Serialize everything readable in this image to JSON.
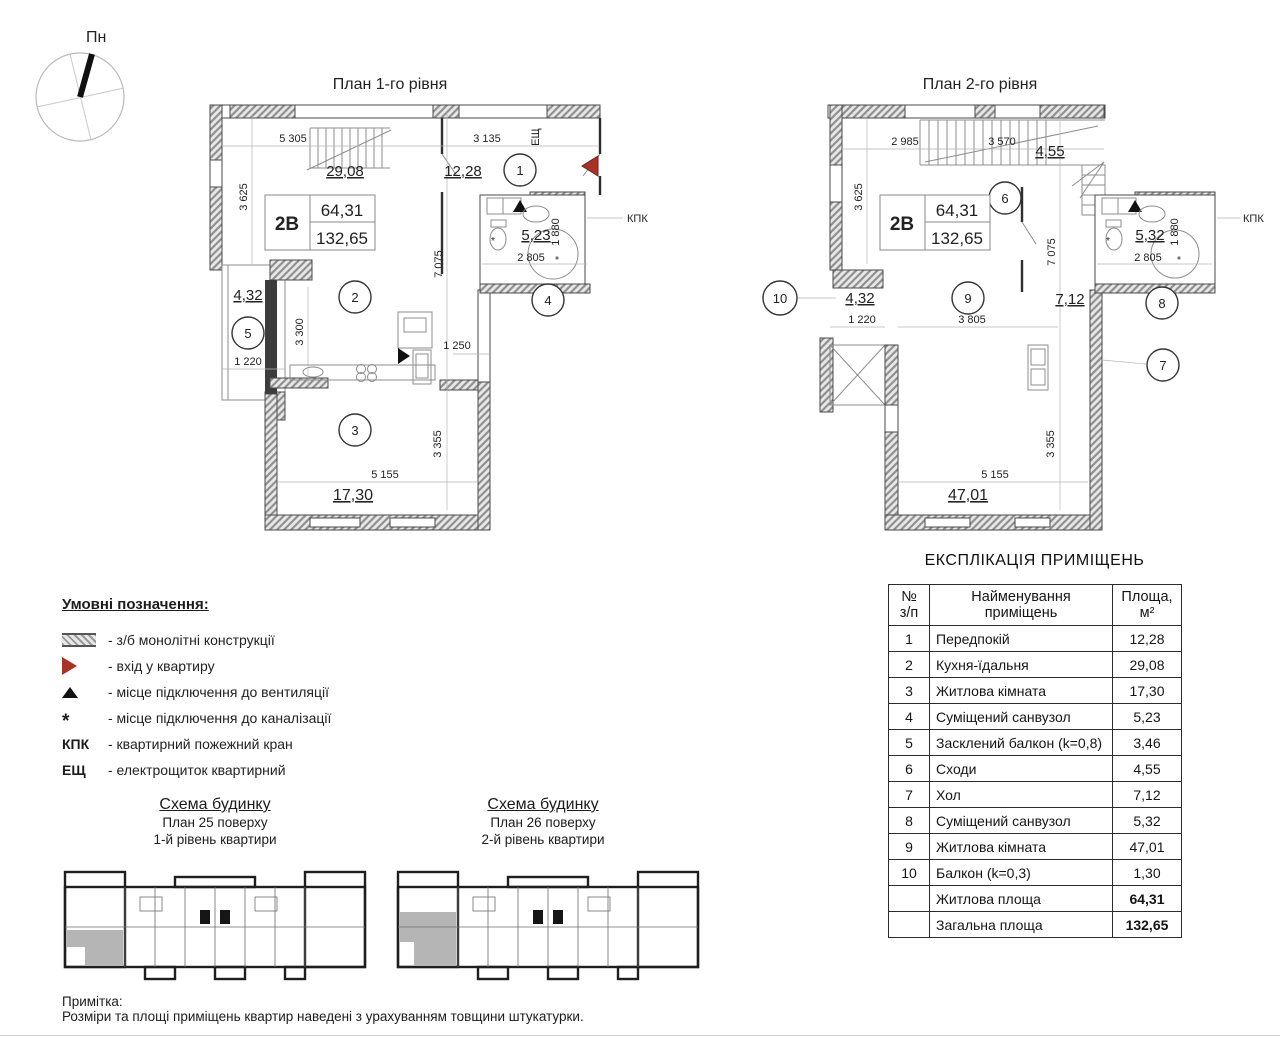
{
  "compass": {
    "label": "Пн"
  },
  "symbols": {
    "sewer": "*"
  },
  "plan1": {
    "title": "План 1-го рівня",
    "unit_type": "2В",
    "living_area": "64,31",
    "total_area": "132,65",
    "rooms": {
      "r1": "1",
      "r2": "2",
      "r3": "3",
      "r4": "4",
      "r5": "5"
    },
    "dims": {
      "top_left": "5 305",
      "top_right": "3 135",
      "kitchen_area": "29,08",
      "hall_area": "12,28",
      "left_height": "3 625",
      "kitchen_height": "3 300",
      "mid_height": "7 075",
      "door_width": "1 250",
      "bath_area": "5,23",
      "bath_depth": "1 880",
      "bath_width": "2 805",
      "balcony_area": "4,32",
      "balcony_width": "1 220",
      "room_height": "3 355",
      "room_width": "5 155",
      "room_area": "17,30"
    },
    "labels": {
      "kpk": "КПК",
      "esh": "ЕЩ"
    }
  },
  "plan2": {
    "title": "План 2-го рівня",
    "unit_type": "2В",
    "living_area": "64,31",
    "total_area": "132,65",
    "rooms": {
      "r6": "6",
      "r7": "7",
      "r8": "8",
      "r9": "9",
      "r10": "10"
    },
    "dims": {
      "top_left": "2 985",
      "top_mid": "3 570",
      "stairs_area": "4,55",
      "left_height": "3 625",
      "mid_height": "7 075",
      "bath_area": "5,32",
      "bath_depth": "1 880",
      "bath_width": "2 805",
      "balcony_area": "4,32",
      "balcony_width": "1 220",
      "room_width_top": "3 805",
      "hall_area": "7,12",
      "room_height": "3 355",
      "room_width": "5 155",
      "room_area": "47,01"
    },
    "labels": {
      "kpk": "КПК"
    }
  },
  "legend": {
    "heading": "Умовні позначення:",
    "items": [
      {
        "symbol": "hatch-swatch",
        "glyph": "",
        "text": "- з/б монолітні конструкції"
      },
      {
        "symbol": "entry-triangle",
        "glyph": "",
        "text": "- вхід у квартиру"
      },
      {
        "symbol": "vent-triangle",
        "glyph": "",
        "text": "- місце підключення до вентиляції"
      },
      {
        "symbol": "sewer-mark",
        "glyph": "*",
        "text": "- місце підключення до каналізації"
      },
      {
        "symbol": "kpk-text",
        "glyph": "КПК",
        "text": "- квартирний пожежний кран"
      },
      {
        "symbol": "esh-text",
        "glyph": "ЕЩ",
        "text": "- електрощиток квартирний"
      }
    ]
  },
  "schemes": [
    {
      "title": "Схема будинку",
      "line1": "План 25 поверху",
      "line2": "1-й рівень квартири"
    },
    {
      "title": "Схема будинку",
      "line1": "План 26 поверху",
      "line2": "2-й рівень квартири"
    }
  ],
  "explication": {
    "title": "ЕКСПЛІКАЦІЯ ПРИМІЩЕНЬ",
    "headers": {
      "num": "№\nз/п",
      "name": "Найменування\nприміщень",
      "area": "Площа,\nм²"
    },
    "rows": [
      {
        "num": "1",
        "name": "Передпокій",
        "area": "12,28"
      },
      {
        "num": "2",
        "name": "Кухня-їдальня",
        "area": "29,08"
      },
      {
        "num": "3",
        "name": "Житлова кімната",
        "area": "17,30"
      },
      {
        "num": "4",
        "name": "Суміщений санвузол",
        "area": "5,23"
      },
      {
        "num": "5",
        "name": "Засклений балкон (k=0,8)",
        "area": "3,46"
      },
      {
        "num": "6",
        "name": "Сходи",
        "area": "4,55"
      },
      {
        "num": "7",
        "name": "Хол",
        "area": "7,12"
      },
      {
        "num": "8",
        "name": "Суміщений санвузол",
        "area": "5,32"
      },
      {
        "num": "9",
        "name": "Житлова кімната",
        "area": "47,01"
      },
      {
        "num": "10",
        "name": "Балкон (k=0,3)",
        "area": "1,30"
      }
    ],
    "totals": [
      {
        "name": "Житлова площа",
        "area": "64,31"
      },
      {
        "name": "Загальна площа",
        "area": "132,65"
      }
    ]
  },
  "note": {
    "title": "Примітка:",
    "text": "Розміри та площі приміщень квартир наведені з урахуванням товщини штукатурки."
  },
  "colors": {
    "entry": "#a93226",
    "wall": "#2f2f2f",
    "hatch_line": "#8f8f8f"
  }
}
